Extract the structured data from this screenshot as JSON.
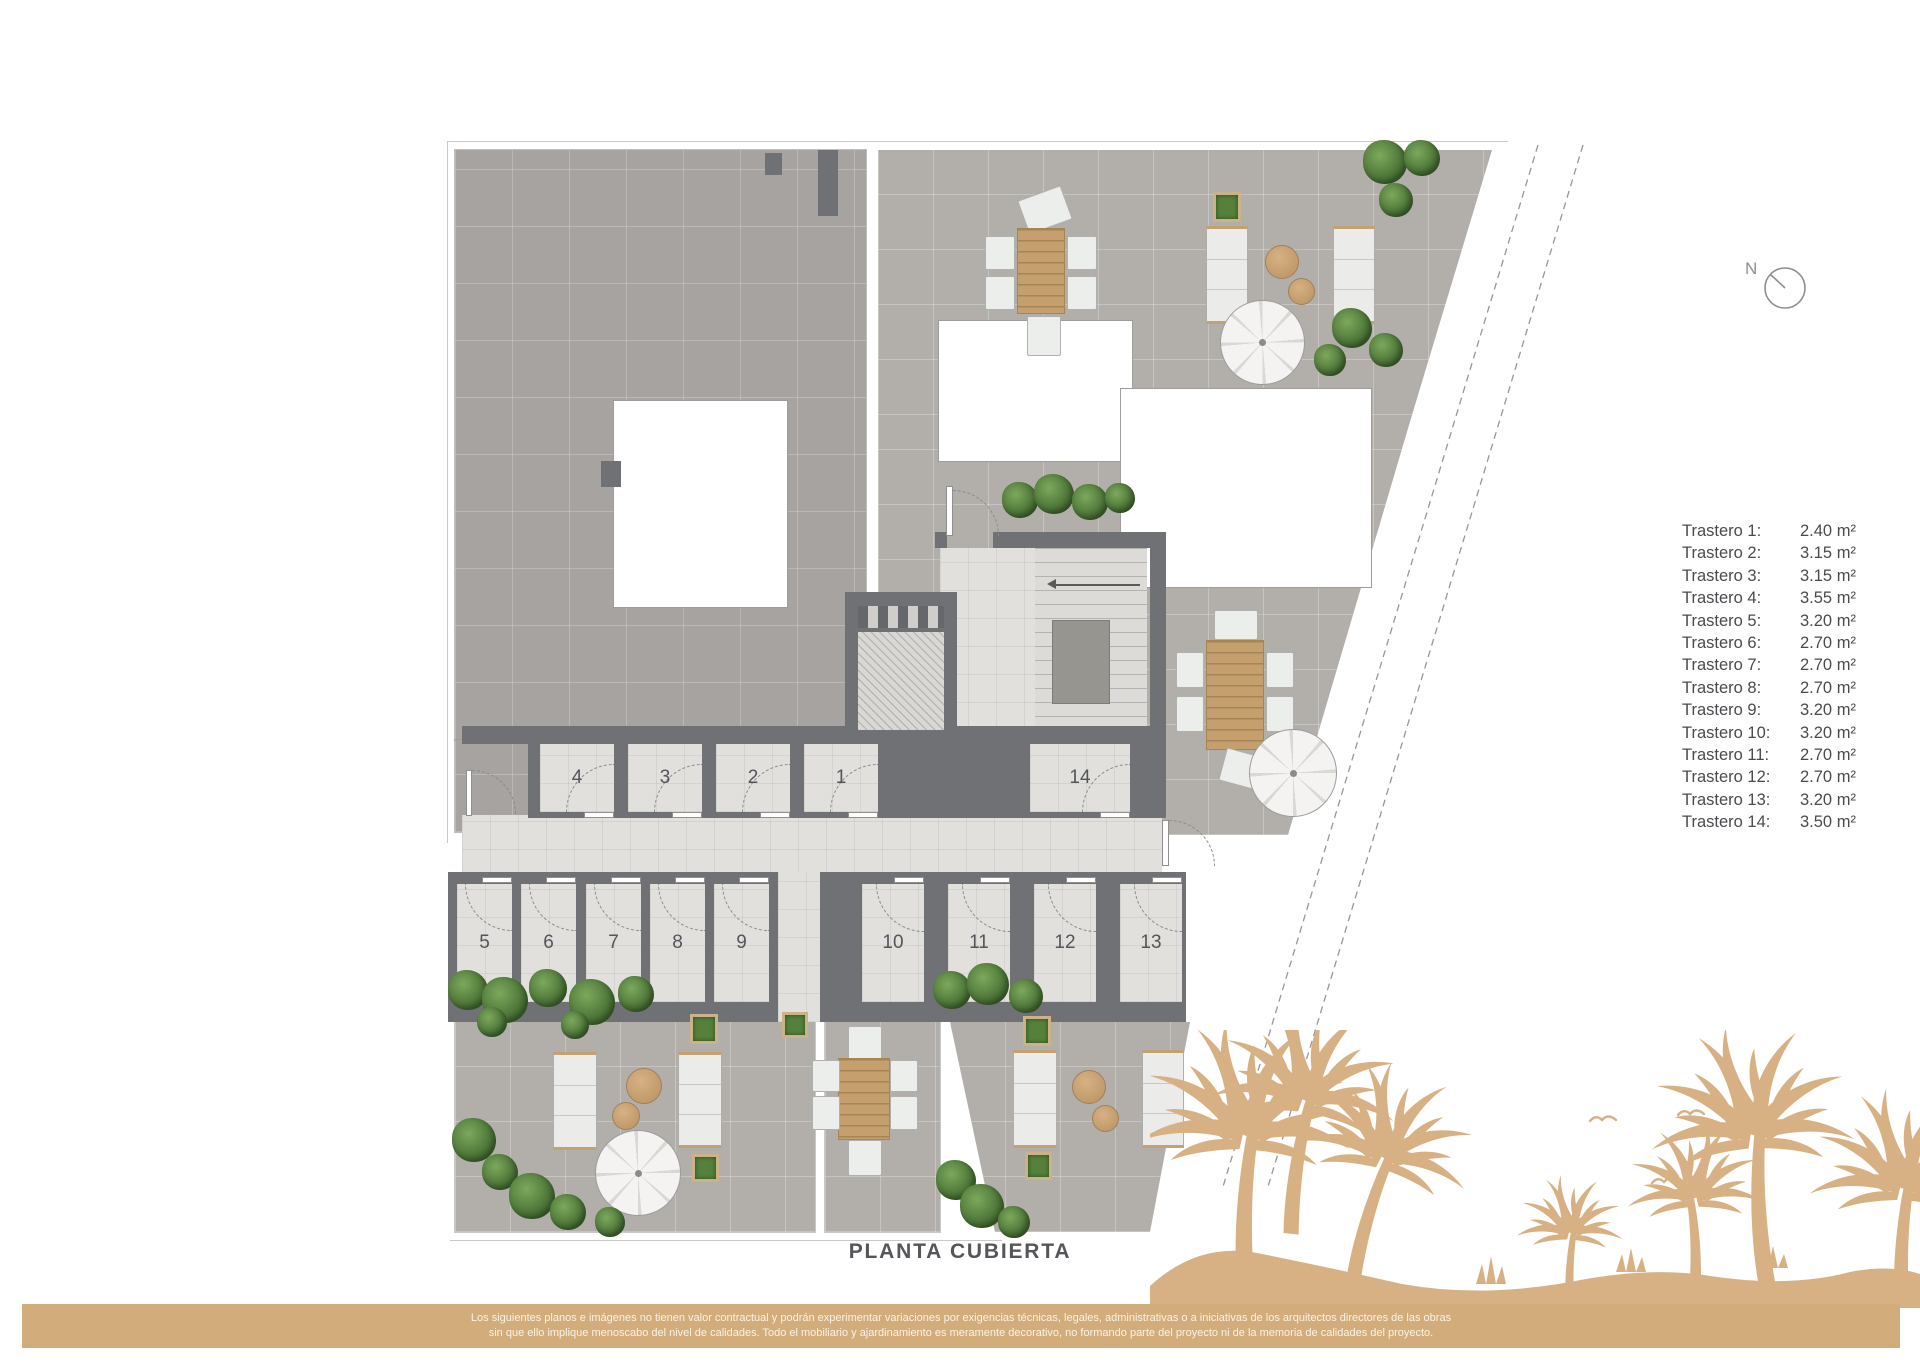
{
  "page": {
    "title_label": "PLANTA CUBIERTA",
    "compass_label": "N"
  },
  "plan": {
    "room_labels": [
      "1",
      "2",
      "3",
      "4",
      "5",
      "6",
      "7",
      "8",
      "9",
      "10",
      "11",
      "12",
      "13",
      "14"
    ]
  },
  "legend": {
    "items": [
      {
        "label": "Trastero 1:",
        "area": "2.40 m²"
      },
      {
        "label": "Trastero 2:",
        "area": "3.15 m²"
      },
      {
        "label": "Trastero 3:",
        "area": "3.15 m²"
      },
      {
        "label": "Trastero 4:",
        "area": "3.55 m²"
      },
      {
        "label": "Trastero 5:",
        "area": "3.20 m²"
      },
      {
        "label": "Trastero 6:",
        "area": "2.70 m²"
      },
      {
        "label": "Trastero 7:",
        "area": "2.70 m²"
      },
      {
        "label": "Trastero 8:",
        "area": "2.70 m²"
      },
      {
        "label": "Trastero 9:",
        "area": "3.20 m²"
      },
      {
        "label": "Trastero 10:",
        "area": "3.20 m²"
      },
      {
        "label": "Trastero 11:",
        "area": "2.70 m²"
      },
      {
        "label": "Trastero 12:",
        "area": "2.70 m²"
      },
      {
        "label": "Trastero 13:",
        "area": "3.20 m²"
      },
      {
        "label": "Trastero 14:",
        "area": "3.50 m²"
      }
    ]
  },
  "footer": {
    "line1": "Los siguientes planos e imágenes no tienen valor contractual y podrán experimentar variaciones por exigencias técnicas, legales, administrativas o a iniciativas de los arquitectos directores de las obras",
    "line2": "sin que ello implique menoscabo del nivel de calidades. Todo el mobiliario y ajardinamiento es meramente decorativo, no formando parte del proyecto ni de la memoria de calidades del proyecto."
  },
  "colors": {
    "accent_tan": "#d3ac7b",
    "palm_tan": "#d7b183",
    "wall_gray": "#6f7174",
    "tile_gray": "#b2afaa"
  }
}
